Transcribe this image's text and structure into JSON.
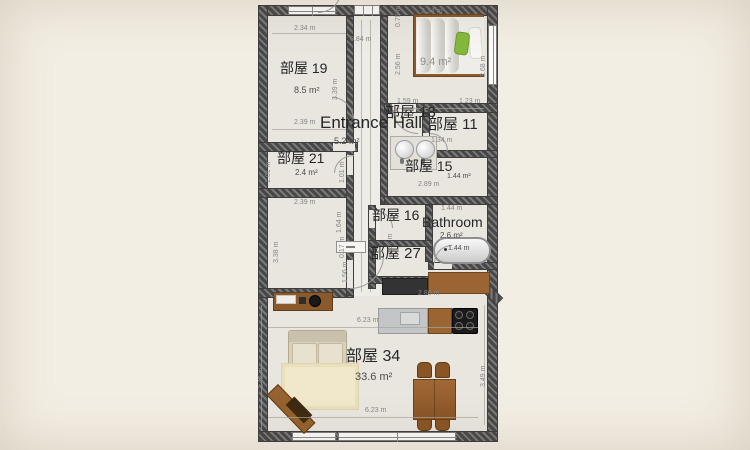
{
  "canvas": {
    "background": "#f3eee3",
    "floor_color": "#e9e6e0",
    "wall_dark": "#474747",
    "wall_light": "#7a7a7a",
    "dim_text_color": "#868686",
    "label_color": "#262626",
    "wood_color": "#96622e",
    "accent_green": "#85b93d"
  },
  "rooms": {
    "r19": {
      "name": "部屋 19",
      "area": "8.5 m²"
    },
    "r21": {
      "name": "部屋 21",
      "area": "2.4 m²"
    },
    "hall": {
      "name": "Entrance Hall",
      "area": "5.2 m²"
    },
    "r13": {
      "name": "部屋 13"
    },
    "r11": {
      "name": "部屋 11"
    },
    "r15": {
      "name": "部屋 15",
      "area": "1.44 m²"
    },
    "bedroom": {
      "area": "9.4 m²"
    },
    "r16": {
      "name": "部屋 16"
    },
    "r27": {
      "name": "部屋 27"
    },
    "bath": {
      "name": "Bathroom",
      "area": "2.6 m²"
    },
    "r34": {
      "name": "部屋 34",
      "area": "33.6 m²"
    }
  },
  "dims": {
    "r19_top": "2.34 m",
    "r19_bottom": "2.39 m",
    "r19_right": "3.39 m",
    "r21_left": "1.01 m",
    "r21_right": "1.01 m",
    "mid_top": "2.39 m",
    "mid_left": "3.38 m",
    "mid_right1": "1.64 m",
    "mid_right2": "0.17 m",
    "mid_right3": "1.56 m",
    "hall_width": "0.84 m",
    "bed_topleft": "0.75 m",
    "bed_left": "2.56 m",
    "bed_top": "2.34 m",
    "bed_right": "2.68 m",
    "bed_bottom_left": "1.59 m",
    "bed_bottom_right": "1.23 m",
    "r11_w": "1.34 m",
    "r15_w": "2.89 m",
    "r16_h": "1.37 m",
    "bath_top": "1.44 m",
    "tub": "1.44 m",
    "kitchen": "2.86 m",
    "lr_top": "6.23 m",
    "lr_bottom": "6.23 m",
    "lr_left": "3.49 m",
    "lr_right": "3.49 m"
  },
  "furniture": [
    "bed",
    "green-pillow",
    "white-pillow",
    "double-sink-vanity",
    "bathtub",
    "sideboard",
    "kitchen-counter",
    "kitchen-sink",
    "cooktop",
    "sofa",
    "rug",
    "dining-table",
    "dining-chair",
    "bench",
    "cabinet"
  ]
}
